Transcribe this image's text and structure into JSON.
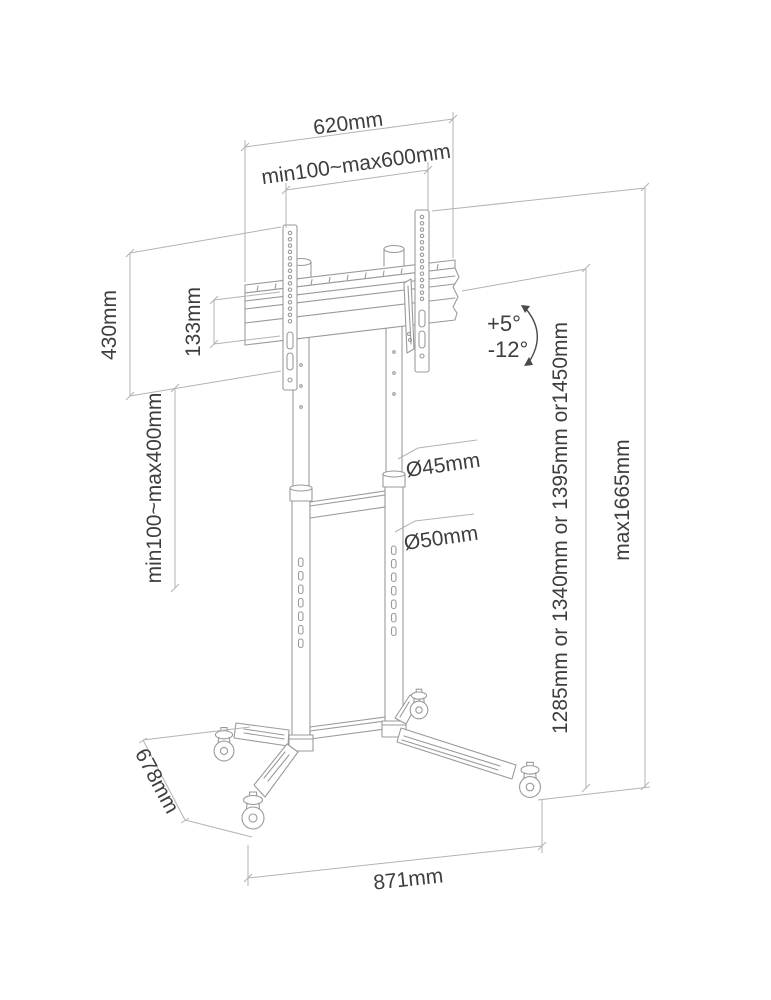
{
  "diagram": {
    "type": "technical-dimension-drawing",
    "subject": "mobile TV floor stand with casters",
    "colors": {
      "background": "#ffffff",
      "outline": "#9a9a9a",
      "dimension": "#b3b3b3",
      "label": "#3e3e3e"
    },
    "labels": {
      "top_width": "620mm",
      "vesa_width_range": "min100~max600mm",
      "bracket_height": "430mm",
      "rail_height": "133mm",
      "vesa_height_range": "min100~max400mm",
      "tilt_up": "+5°",
      "tilt_down": "-12°",
      "upper_pole_diameter": "Ø45mm",
      "lower_pole_diameter": "Ø50mm",
      "column_height_options": "1285mm or 1340mm or 1395mm or1450mm",
      "max_height": "max1665mm",
      "base_depth": "678mm",
      "base_width": "871mm"
    }
  }
}
